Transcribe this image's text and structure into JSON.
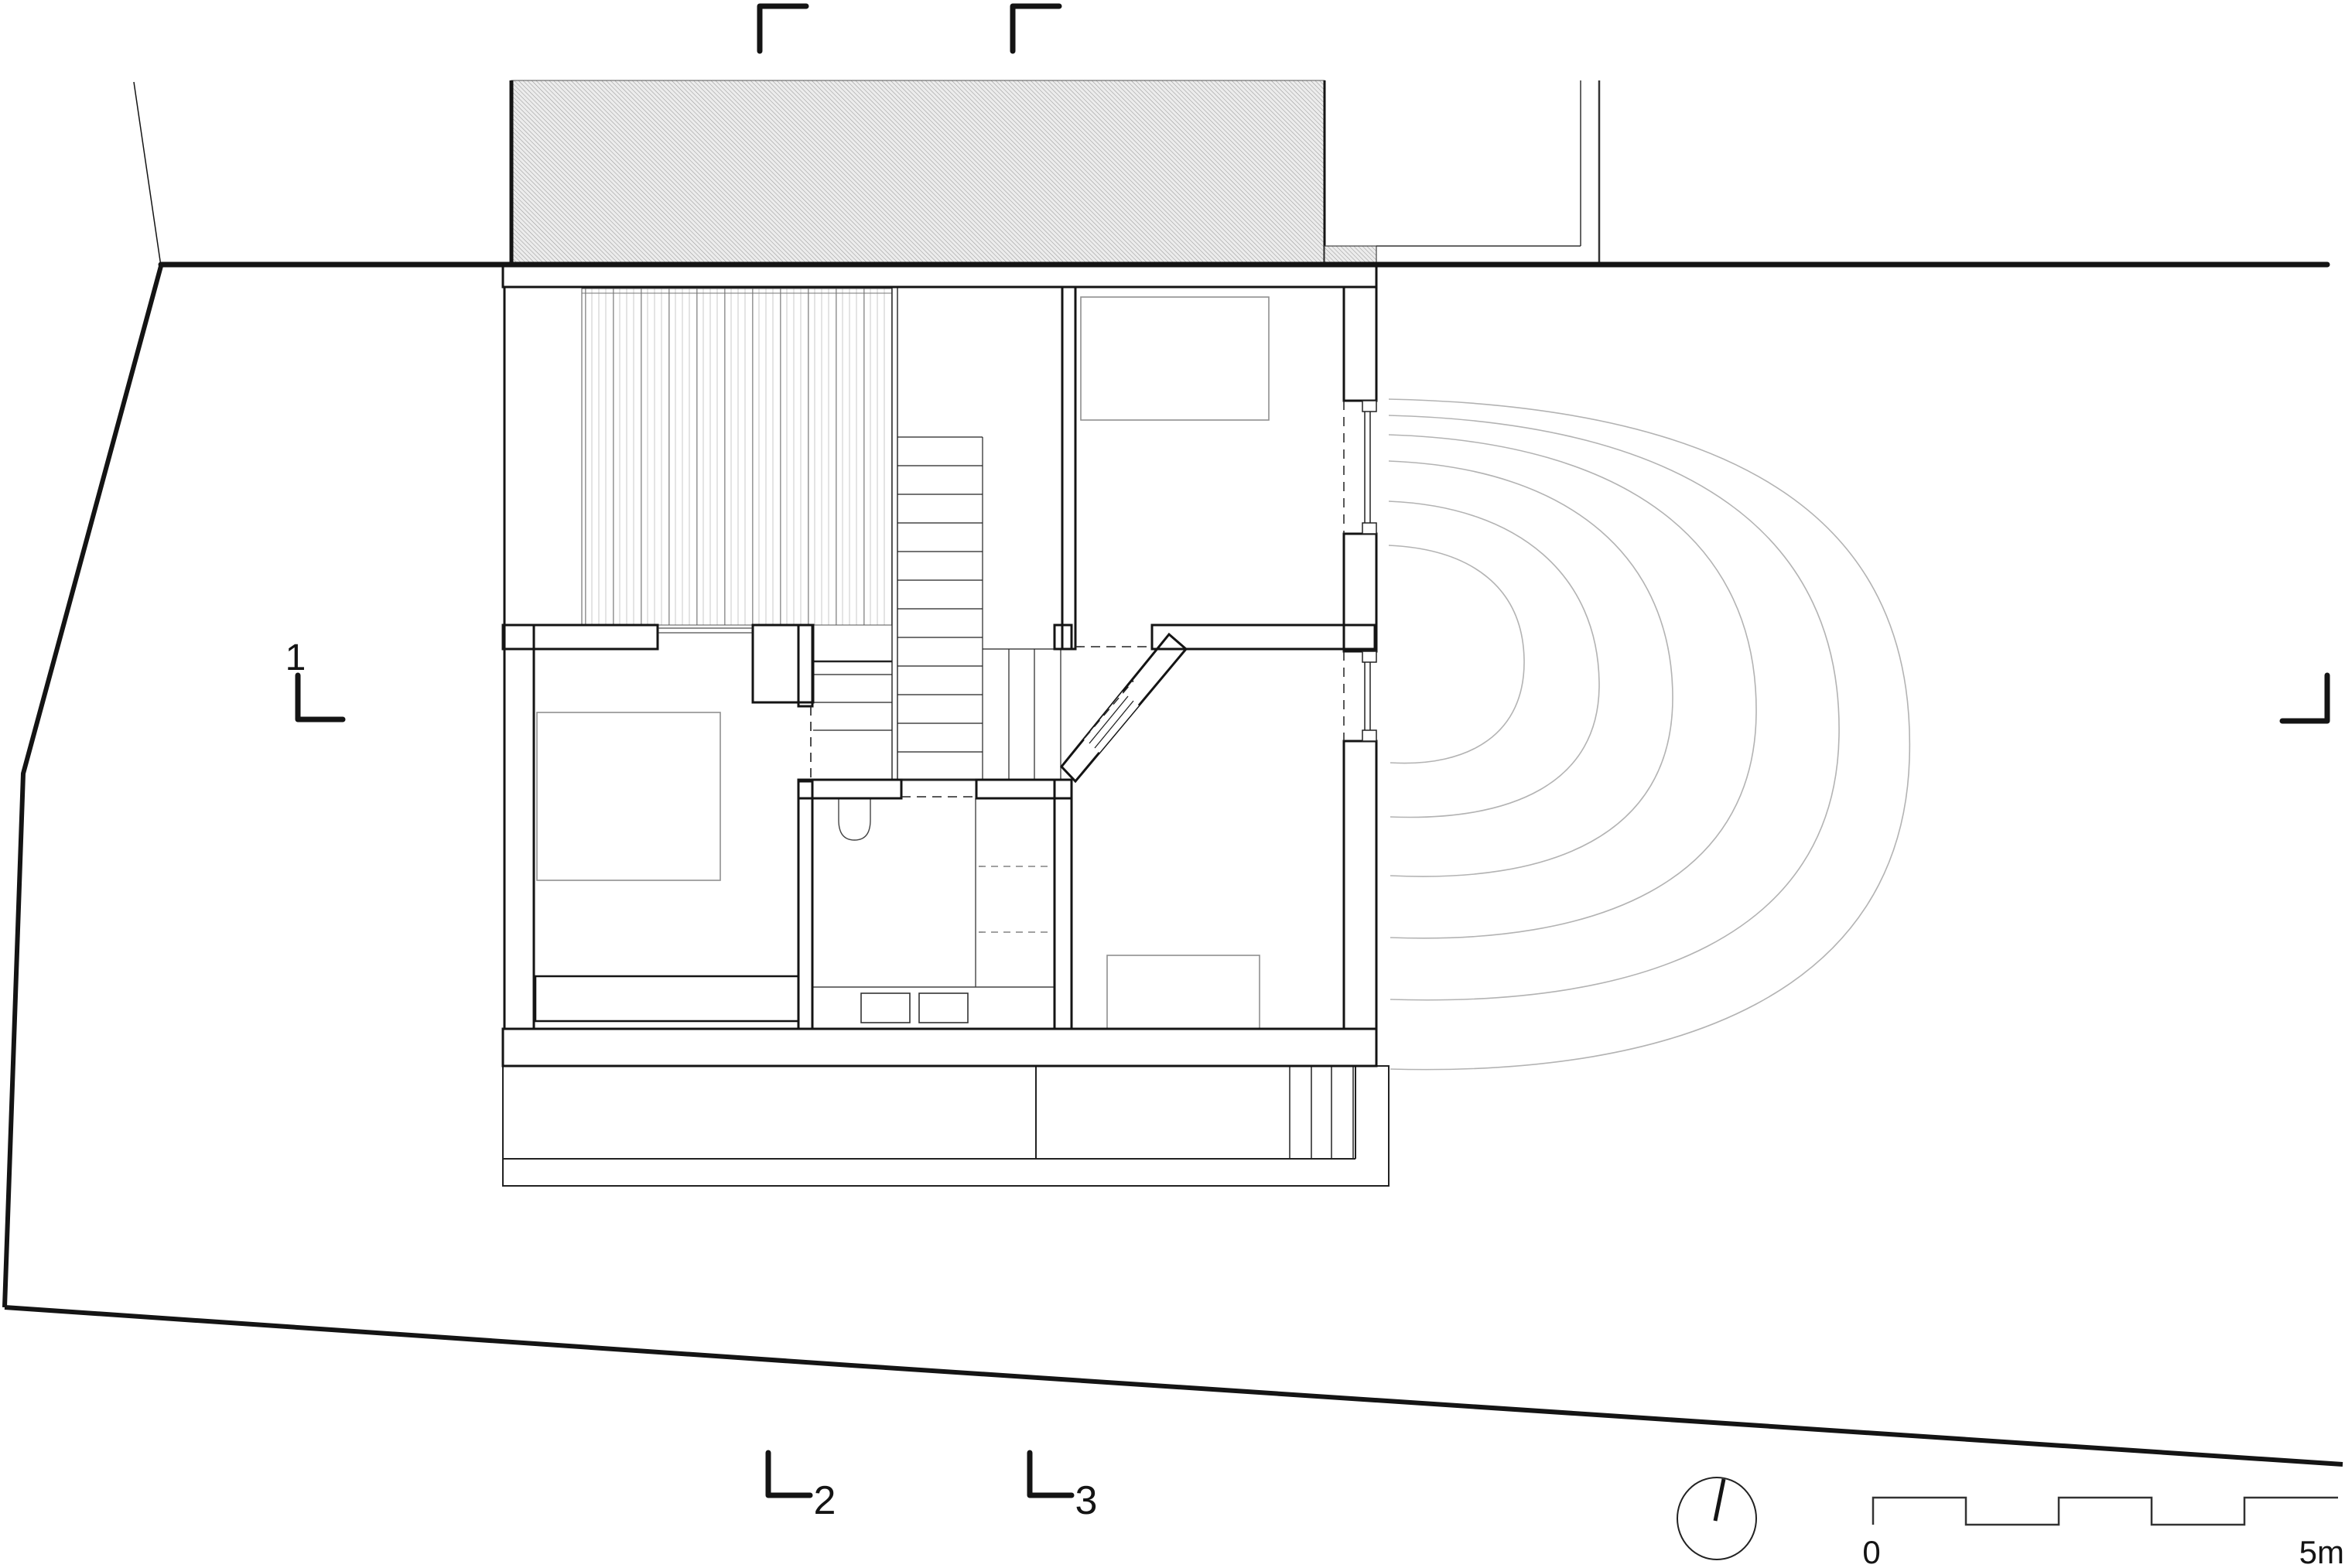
{
  "drawing": {
    "kind": "architectural-floor-plan",
    "annotations": {
      "section_1_label": "1",
      "section_2_label": "2",
      "section_3_label": "3",
      "scale_zero_label": "0",
      "scale_end_label": "5m"
    },
    "icons": {
      "north_arrow": "north-arrow-icon",
      "scale_bar": "scale-bar-icon",
      "section_markers": "section-cut-marker-icon"
    },
    "colors": {
      "line": "#141414",
      "wall_hatch": "#3a3a3a",
      "neighbor_hatch": "#8a8a8a",
      "neighbor_fill": "#ececec",
      "furniture": "#8f8f8f",
      "contour": "#b3b3b3",
      "deck_stripe": "#9a9a9a"
    }
  }
}
